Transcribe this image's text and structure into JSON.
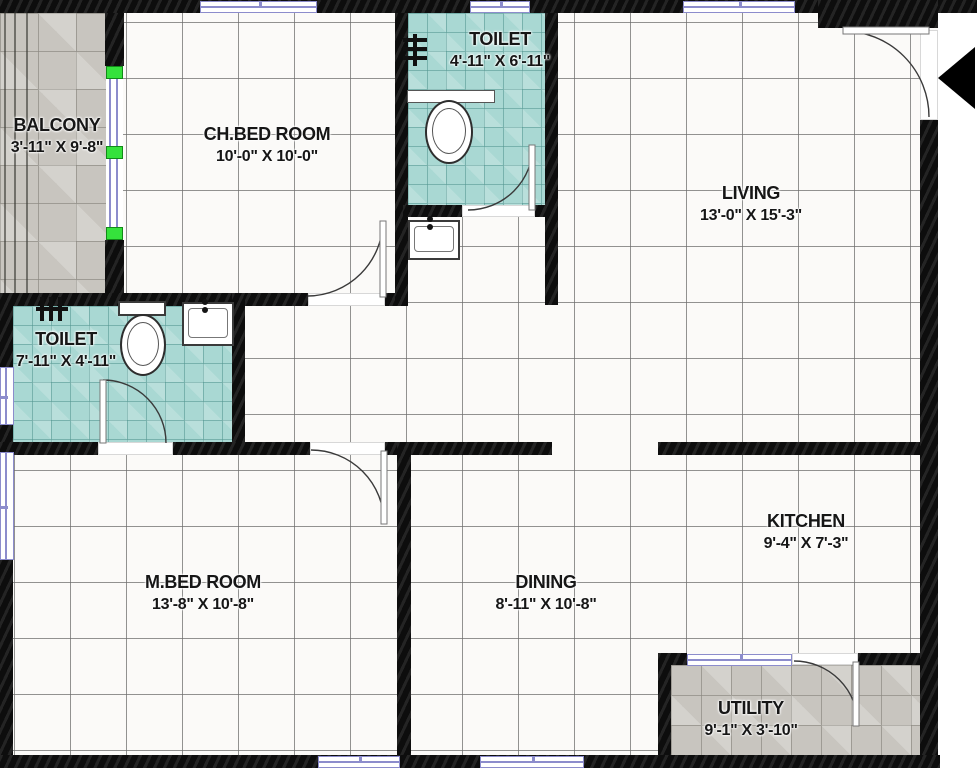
{
  "plan": {
    "type": "residential-floor-plan",
    "rooms": [
      {
        "id": "balcony",
        "name": "BALCONY",
        "dims": "3'-11\" X 9'-8\""
      },
      {
        "id": "ch-bed-room",
        "name": "CH.BED ROOM",
        "dims": "10'-0\" X 10'-0\""
      },
      {
        "id": "toilet-common",
        "name": "TOILET",
        "dims": "4'-11\" X 6'-11\""
      },
      {
        "id": "living",
        "name": "LIVING",
        "dims": "13'-0\" X 15'-3\""
      },
      {
        "id": "toilet-master",
        "name": "TOILET",
        "dims": "7'-11\" X 4'-11\""
      },
      {
        "id": "m-bed-room",
        "name": "M.BED ROOM",
        "dims": "13'-8\" X 10'-8\""
      },
      {
        "id": "dining",
        "name": "DINING",
        "dims": "8'-11\" X 10'-8\""
      },
      {
        "id": "kitchen",
        "name": "KITCHEN",
        "dims": "9'-4\" X 7'-3\""
      },
      {
        "id": "utility",
        "name": "UTILITY",
        "dims": "9'-1\" X 3'-10\""
      }
    ],
    "colors": {
      "wall": "#0d0d0d",
      "toilet_tile": "#a9d8d3",
      "outdoor_tile": "#c8c5bf",
      "window_frame": "#8c8ccc",
      "slider_marker_green": "#35e23c",
      "entry_arrow": "#000000"
    },
    "fixtures": [
      "wc",
      "wash-basin",
      "shower-mixer",
      "door-swing",
      "window",
      "sliding-window",
      "entry-arrow"
    ]
  }
}
